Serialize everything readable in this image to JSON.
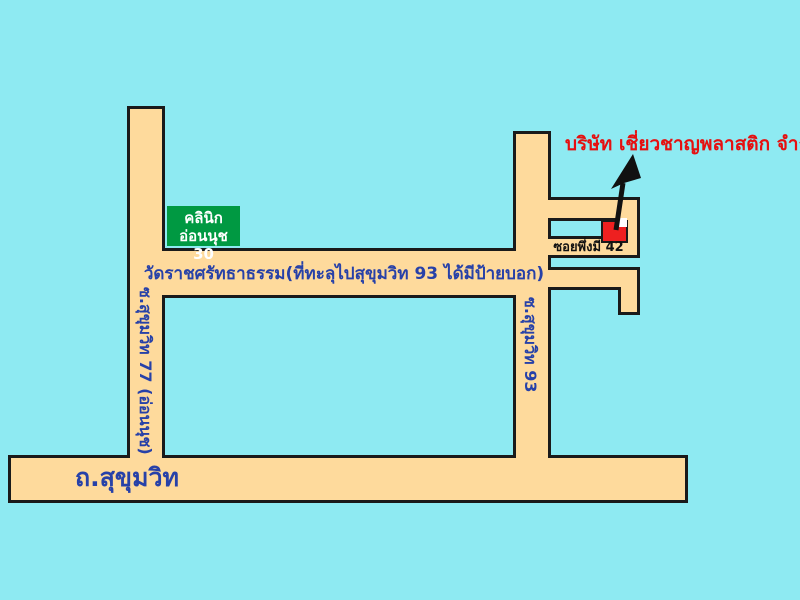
{
  "map": {
    "company_label": "บริษัท เชี่ยวชาญพลาสติก จำกัด",
    "clinic_sign": {
      "line1": "คลินิก",
      "line2": "อ่อนนุช 30"
    },
    "middle_road_note": "วัดราชศรัทธาธรรม(ที่ทะลุไปสุขุมวิท 93 ได้มีป้ายบอก)",
    "soi_phuengmi_label": "ซอยพึ่งมี 42",
    "bottom_road_label": "ถ.สุขุมวิท",
    "left_road_label": "ซ.สุขุมวิท 77 (อ่อนนุช)",
    "right_road_label": "ซ.สุขุมวิท 93"
  },
  "colors": {
    "background": "#8EEAF2",
    "road_fill": "#FEDA9C",
    "road_border": "#1A1A1A",
    "sign_green": "#009942",
    "marker_red": "#EE2020",
    "company_text_red": "#E51010",
    "road_text_blue": "#2741A8",
    "soi_text_black": "#111111",
    "sign_text_white": "#FFFFFF"
  }
}
